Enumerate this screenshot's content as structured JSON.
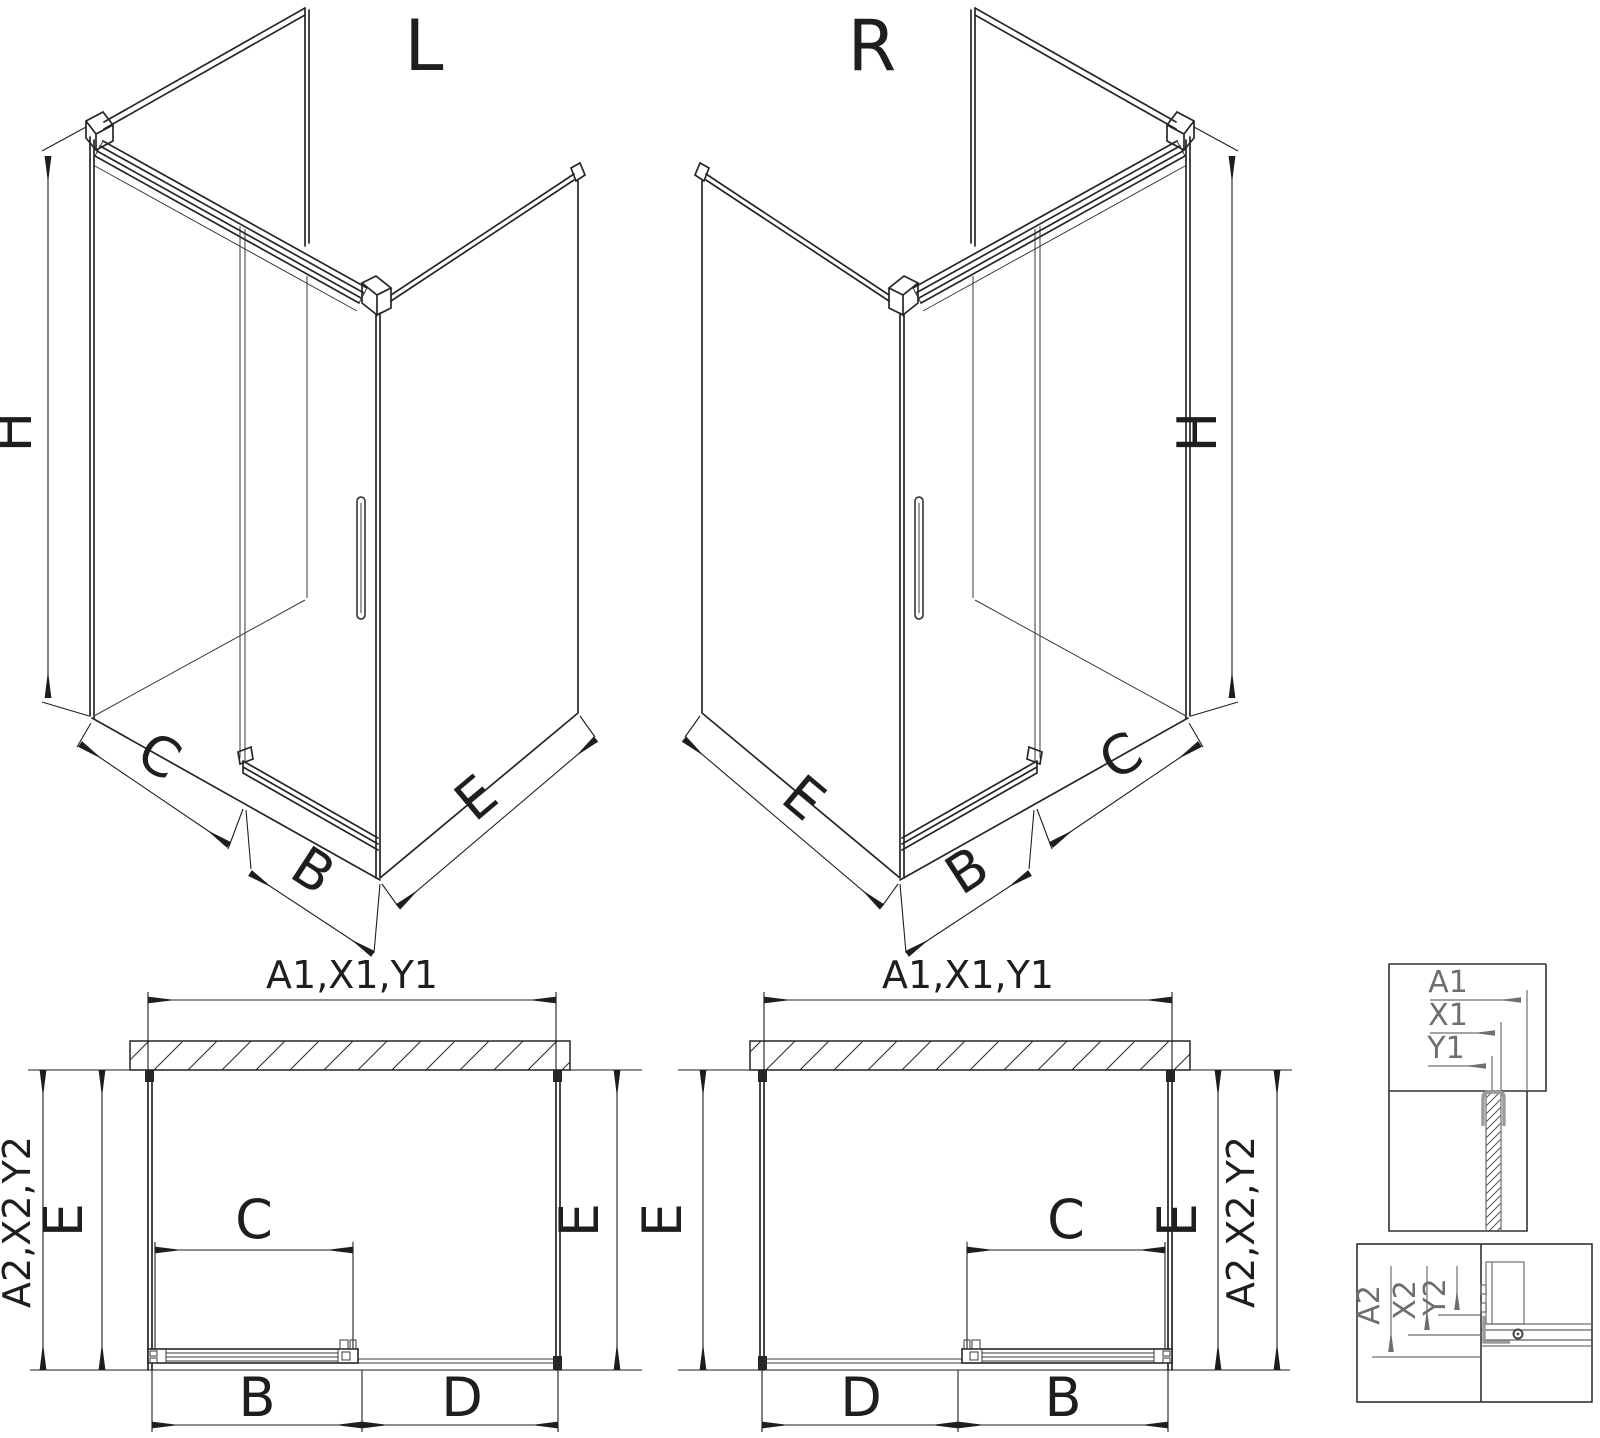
{
  "drawing_title": "Shower enclosure technical drawing - L and R versions",
  "iso_left": {
    "title": "L",
    "h": "H",
    "c": "C",
    "b": "B",
    "e": "E"
  },
  "iso_right": {
    "title": "R",
    "h": "H",
    "c": "C",
    "b": "B",
    "e": "E"
  },
  "plan_left": {
    "width_top": "A1,X1,Y1",
    "depth_outer": "A2,X2,Y2",
    "e_left": "E",
    "e_right": "E",
    "c": "C",
    "b": "B",
    "d": "D"
  },
  "plan_right": {
    "width_top": "A1,X1,Y1",
    "depth_outer": "A2,X2,Y2",
    "e_left": "E",
    "e_right": "E",
    "c": "C",
    "b": "B",
    "d": "D"
  },
  "detail_top": {
    "a1": "A1",
    "x1": "X1",
    "y1": "Y1"
  },
  "detail_bottom": {
    "a2": "A2",
    "x2": "X2",
    "y2": "Y2"
  },
  "colors": {
    "line": "#262626",
    "dimension": "#1e1e1e",
    "detail_gray": "#9a9a9a",
    "detail_dim": "#6e6e6e",
    "background": "#ffffff"
  }
}
